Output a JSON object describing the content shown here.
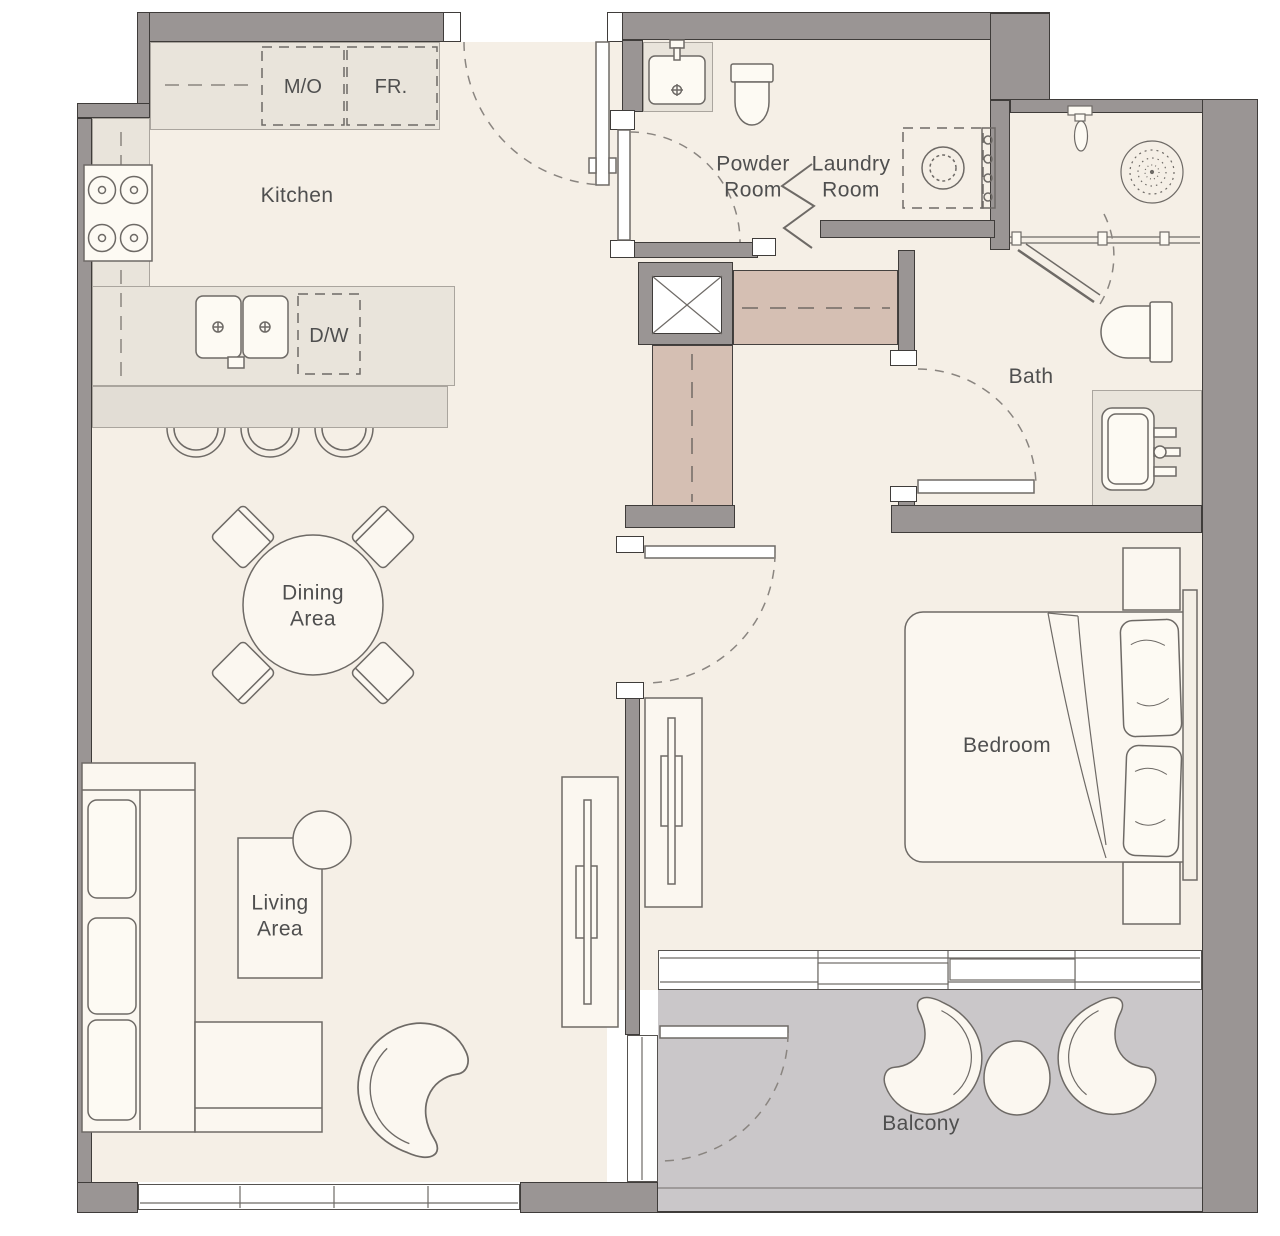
{
  "rooms": {
    "kitchen": "Kitchen",
    "powder": "Powder\nRoom",
    "laundry": "Laundry\nRoom",
    "bath": "Bath",
    "dining": "Dining\nArea",
    "living": "Living\nArea",
    "bedroom": "Bedroom",
    "balcony": "Balcony"
  },
  "appliances": {
    "microwave": "M/O",
    "fridge": "FR.",
    "dishwasher": "D/W"
  },
  "fixtures": [
    "cooktop-4-burner",
    "double-sink",
    "bar-stools",
    "washbasin",
    "toilet",
    "washing-machine",
    "shower-head",
    "shower-door",
    "vanity-sink",
    "double-bed",
    "pillows",
    "nightstands",
    "tv-console",
    "sofa-l-shape",
    "coffee-table",
    "side-table",
    "armchair",
    "round-dining-table",
    "dining-chairs",
    "lounge-chairs",
    "balcony-table",
    "wardrobe",
    "duct-shaft"
  ],
  "colors": {
    "wall": "#9a9594",
    "wall_outline": "#3f3c3a",
    "floor": "#f5efe6",
    "counter": "#e9e4db",
    "wardrobe": "#d5bfb3",
    "balcony_floor": "#cac7c9",
    "furniture_line": "#6e6a66",
    "label_text": "#4f4f4f"
  }
}
